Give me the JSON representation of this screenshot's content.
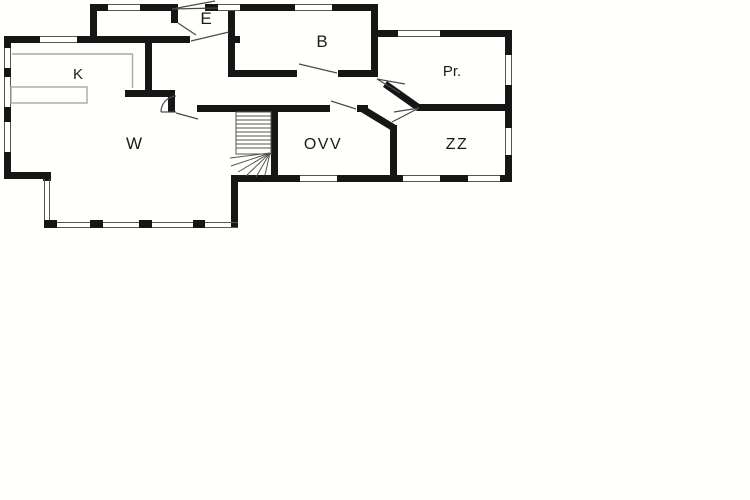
{
  "colors": {
    "background": "#fffffc",
    "wall": "#161616",
    "detail_line": "#555555",
    "swing_line": "#4a4a4a",
    "gray_line": "#a9a9a9",
    "label": "#1b1b1b"
  },
  "rooms": {
    "e": {
      "label": "E"
    },
    "b": {
      "label": "B"
    },
    "pr": {
      "label": "Pr."
    },
    "k": {
      "label": "K"
    },
    "w": {
      "label": "W"
    },
    "ovv": {
      "label": "OVV"
    },
    "zz": {
      "label": "ZZ"
    }
  }
}
